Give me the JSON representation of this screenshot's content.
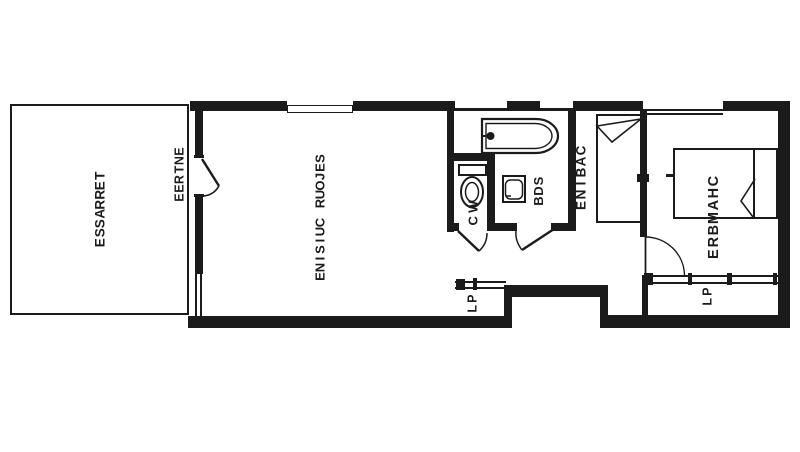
{
  "plan": {
    "colors": {
      "ink": "#1b1b1b",
      "paper": "#ffffff"
    },
    "rooms": {
      "terrasse": {
        "label": "TERRASSE"
      },
      "entree": {
        "label": "ENTREE"
      },
      "sejour_cuisine": {
        "label": "SEJOUR CUISINE"
      },
      "wc": {
        "label": "WC"
      },
      "sdb": {
        "label": "SDB"
      },
      "cabine": {
        "label": "CABINE"
      },
      "chambre": {
        "label": "CHAMBRE"
      },
      "placard_couloir": {
        "label": "PL"
      },
      "placard_chambre": {
        "label": "PL"
      }
    }
  }
}
